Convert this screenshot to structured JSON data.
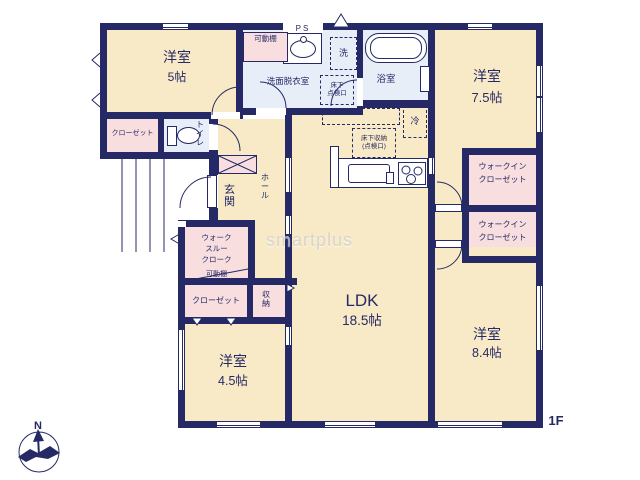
{
  "colors": {
    "wall": "#252a66",
    "room": "#f8eac6",
    "wet": "#e7eef8",
    "closet": "#f8dede",
    "text": "#252a66",
    "watermark": "#cfcfcf"
  },
  "floor_label": "1F",
  "watermark": "smartplus",
  "compass": {
    "north": "N"
  },
  "rooms": {
    "room5": {
      "name": "洋室",
      "size": "5帖"
    },
    "room75": {
      "name": "洋室",
      "size": "7.5帖"
    },
    "room45": {
      "name": "洋室",
      "size": "4.5帖"
    },
    "room84": {
      "name": "洋室",
      "size": "8.4帖"
    },
    "ldk": {
      "name": "LDK",
      "size": "18.5帖"
    },
    "washroom": {
      "name": "洗面脱衣室"
    },
    "bath": {
      "name": "浴室"
    },
    "toilet": {
      "name": "トイレ"
    },
    "genkan": {
      "name": "玄関"
    },
    "hall": {
      "name": "ホール"
    },
    "closet_upper": {
      "name": "クローゼット"
    },
    "closet_lower": {
      "name": "クローゼット"
    },
    "storage": {
      "name": "収納"
    },
    "wic_upper": {
      "line1": "ウォークイン",
      "line2": "クローゼット"
    },
    "wic_lower": {
      "line1": "ウォークイン",
      "line2": "クローゼット"
    },
    "walk_through_cloak": {
      "line1": "ウォーク",
      "line2": "スルー",
      "line3": "クローク"
    }
  },
  "fixtures": {
    "ps": "PS",
    "washer": "洗",
    "fridge": "冷",
    "movable_shelf_top": "可動棚",
    "movable_shelf_lower": "可動棚",
    "underfloor_hatch": {
      "line1": "床下",
      "line2": "点検口"
    },
    "underfloor_storage": {
      "line1": "床下収納",
      "line2": "(点検口)"
    }
  }
}
